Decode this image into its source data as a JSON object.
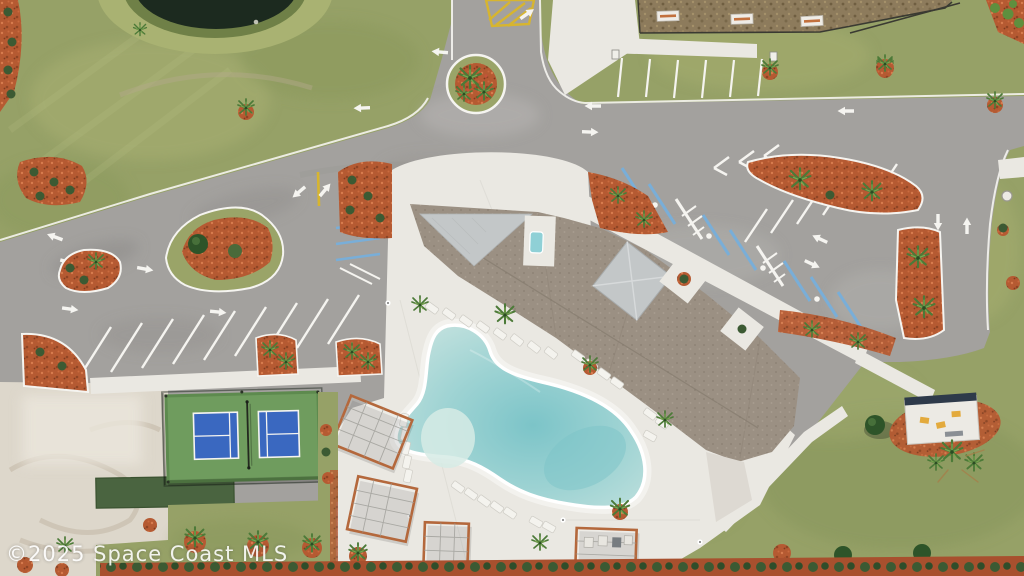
{
  "watermark": {
    "text": "©2025 Space Coast MLS"
  },
  "scene": {
    "type": "aerial-drone-photo",
    "subject": "community amenity center with clubhouse, free-form pool, pickleball court, parking lots, roundabout and pond",
    "features": [
      "pond",
      "roundabout",
      "clubhouse-roof",
      "swimming-pool",
      "pool-deck",
      "pergolas",
      "pickleball-court",
      "bocce-strip",
      "sand-area",
      "west-parking-lot",
      "east-parking-lot",
      "accessible-parking-row",
      "dog-park-pad",
      "mail-kiosk",
      "landscape-islands",
      "hedge-row",
      "grass"
    ]
  },
  "colors": {
    "grass": "#96a167",
    "grass_dark": "#86955a",
    "grass_light": "#aab274",
    "pond": "#1c2a1f",
    "bank": "#a9b272",
    "asphalt": "#a3a19e",
    "asphalt_dark": "#8e8c89",
    "asphalt_light": "#bab8b5",
    "concrete": "#eae8e2",
    "concrete_bright": "#f2f0ea",
    "roof": "#9b9083",
    "roof_light": "#c3c7c8",
    "pool": "#9ed3d3",
    "pool_deep": "#7cc4c8",
    "pool_shallow": "#d6ebe5",
    "mulch": "#b55a32",
    "mulch_dark": "#8e4424",
    "court_green": "#6f9c5e",
    "court_blue": "#3a68c0",
    "turf_dark": "#4a6440",
    "sand": "#ddd7cb",
    "sand_dark": "#c3b8a6",
    "pad_brown": "#8d7b5c",
    "hedge_green": "#3c5a33",
    "hedge_mulch": "#a8502e",
    "line_white": "#f5f4f0",
    "line_yellow": "#d7b52f",
    "hc_blue": "#79aed8",
    "palm_green": "#4c7a38",
    "palm_dark": "#2c4d24",
    "wood": "#b4683c",
    "pavilion_navy": "#2e3a4a",
    "pavilion_yellow": "#e3aa3c"
  }
}
